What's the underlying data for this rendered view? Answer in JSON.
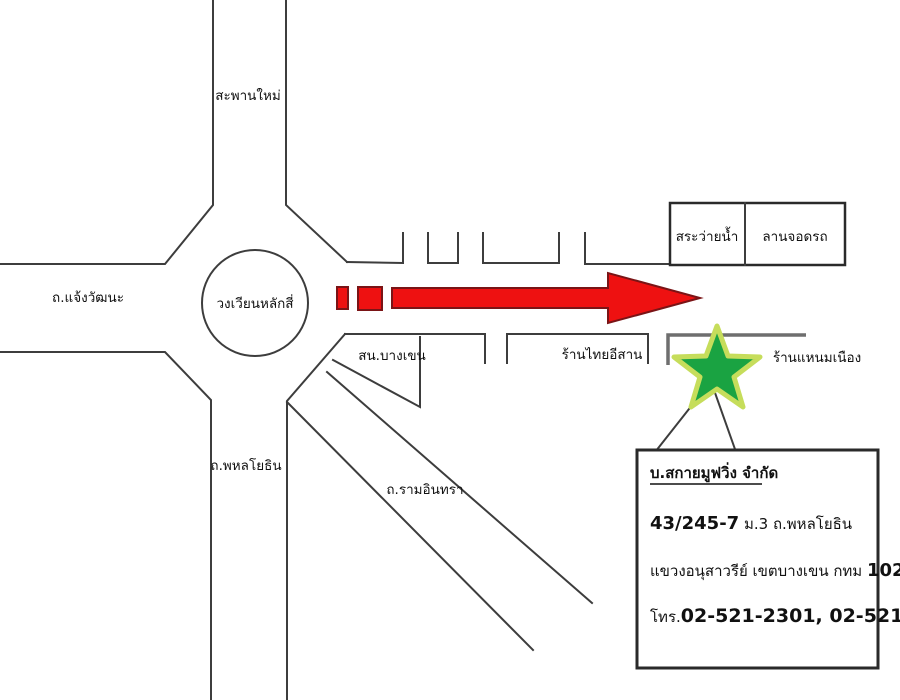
{
  "map": {
    "labels": {
      "saphan_mai": "สะพานใหม่",
      "chaengwattana_rd": "ถ.แจ้งวัฒนะ",
      "roundabout": "วงเวียนหลักสี่",
      "phahonyothin_rd": "ถ.พหลโยธิน",
      "ram_inthra_rd": "ถ.รามอินทรา",
      "swimming_pool": "สระว่ายน้ำ",
      "parking_lot": "ลานจอดรถ",
      "police_station": "สน.บางเขน",
      "thai_isan_shop": "ร้านไทยอีสาน",
      "naem_nueang_shop": "ร้านแหนมเนือง"
    },
    "marker": {
      "icon": "star-icon",
      "fill": "#1aa342",
      "outline": "#c6dd5b"
    },
    "arrow": {
      "icon": "right-arrow-icon",
      "fill": "#ee1111",
      "outline": "#7a1416"
    },
    "line_color": "#3d3d3d"
  },
  "info_box": {
    "company": "บ.สกายมูฟวิ่ง จำกัด",
    "address_number": "43/245-7",
    "address_rest": " ม.3 ถ.พหลโยธิน",
    "district": "แขวงอนุสาวรีย์ เขตบางเขน กทม ",
    "postcode": "10220",
    "phone_label": "โทร.",
    "phone_numbers": "02-521-2301, 02-521-1856"
  }
}
